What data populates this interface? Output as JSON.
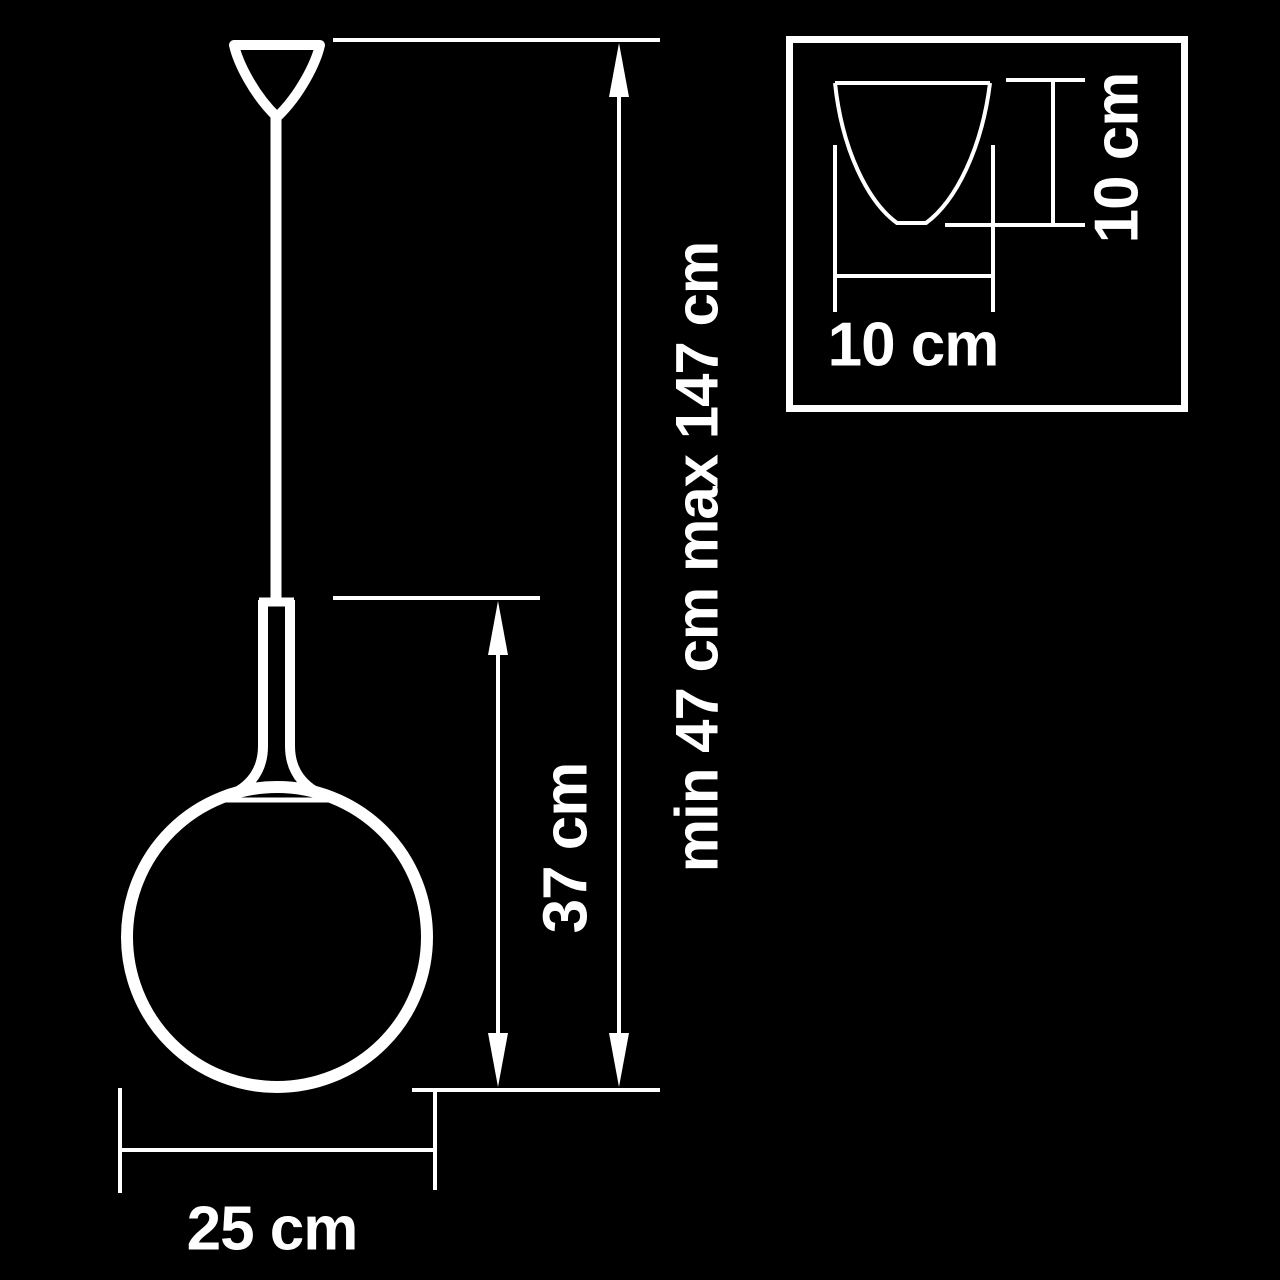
{
  "colors": {
    "background": "#000000",
    "line": "#ffffff",
    "text": "#ffffff"
  },
  "dimensions": {
    "overall_height": "min 47 cm max 147 cm",
    "shade_height": "37 cm",
    "shade_diameter": "25 cm",
    "canopy_width": "10 cm",
    "canopy_height": "10 cm"
  }
}
